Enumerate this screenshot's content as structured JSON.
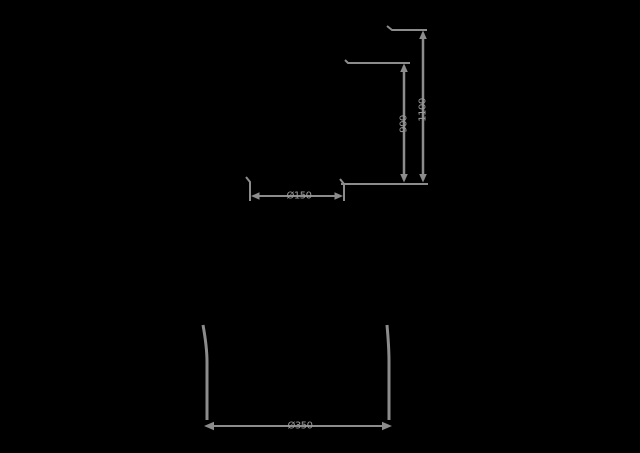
{
  "canvas": {
    "background_color": "#000000",
    "line_color": "#8c8c8c",
    "text_color": "#9a9a9a"
  },
  "diagram": {
    "type": "product-dimension-drawing",
    "labels": {
      "height_total": "1100",
      "height_partial": "900",
      "diameter_top": "Ø150",
      "diameter_base": "Ø350"
    }
  }
}
